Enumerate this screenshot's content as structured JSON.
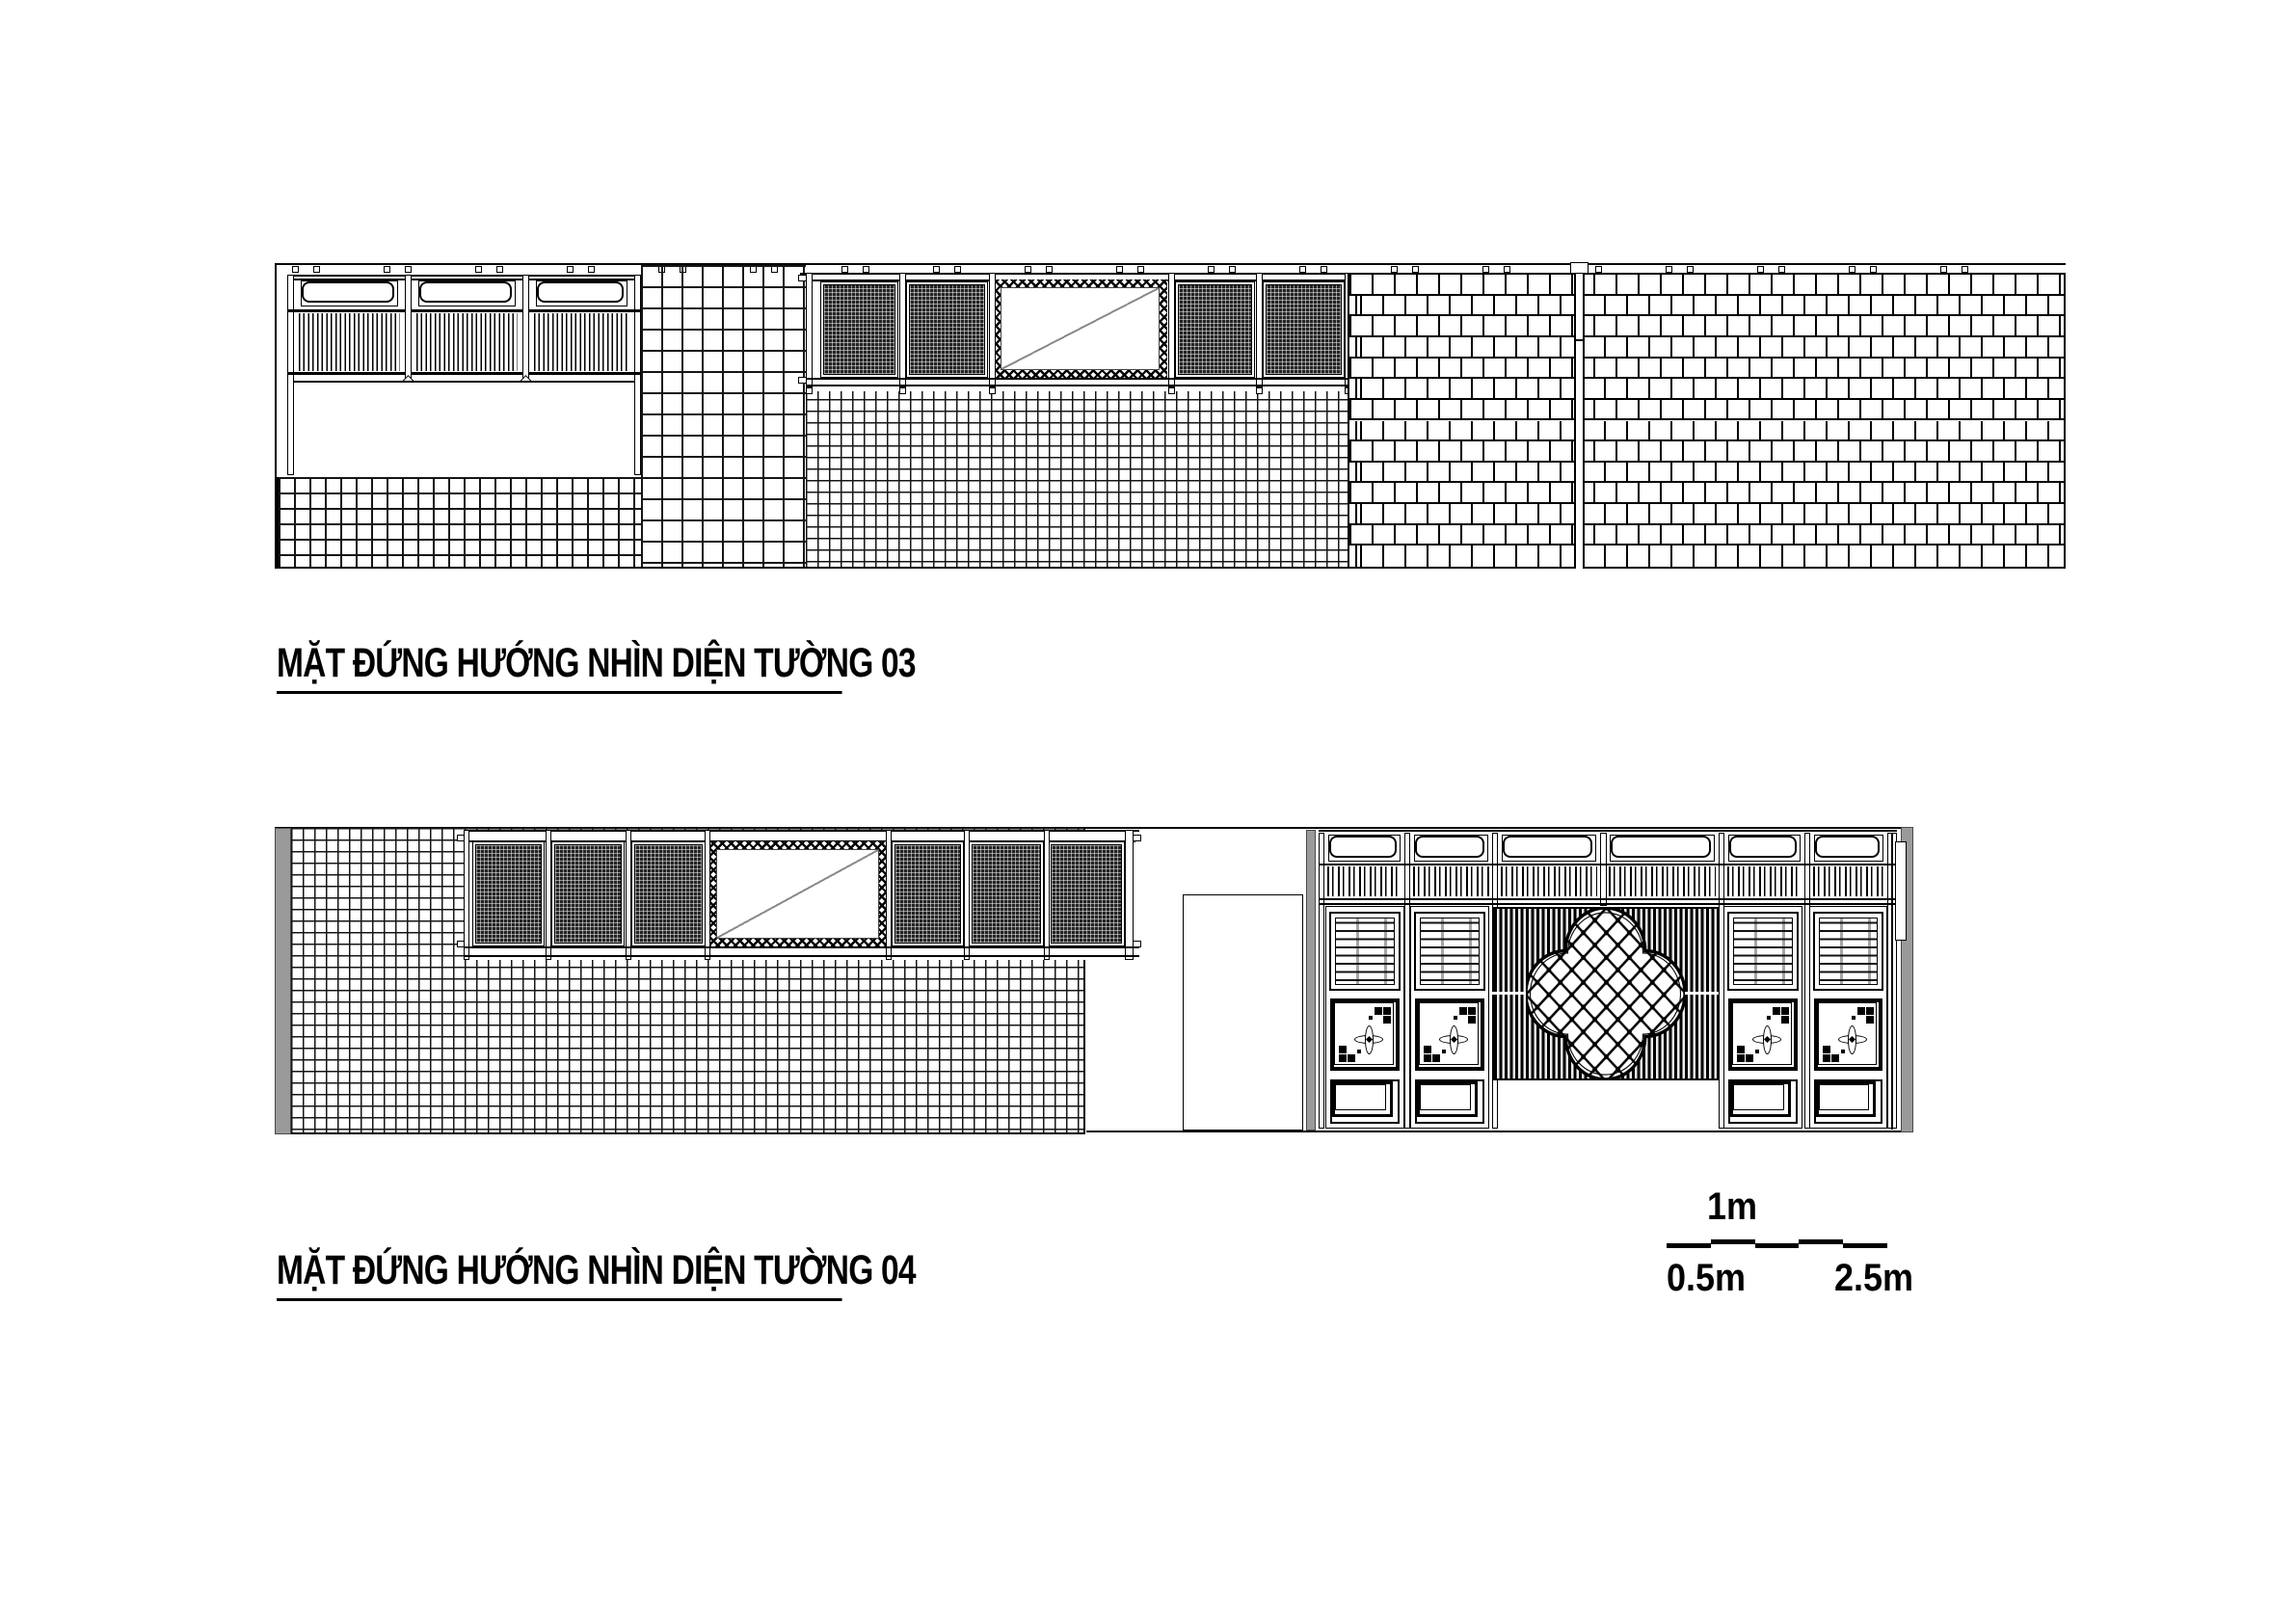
{
  "document": {
    "background": "#ffffff",
    "line_color": "#000000",
    "gray_accent": "#9a9a9a"
  },
  "drawings": [
    {
      "id": "wall-03",
      "title": "MẶT ĐỨNG HƯỚNG NHÌN DIỆN TƯỜNG 03"
    },
    {
      "id": "wall-04",
      "title": "MẶT ĐỨNG HƯỚNG NHÌN DIỆN TƯỜNG 04"
    }
  ],
  "scale_bar": {
    "label_top": "1m",
    "label_bottom_left": "0.5m",
    "label_bottom_right": "2.5m"
  }
}
